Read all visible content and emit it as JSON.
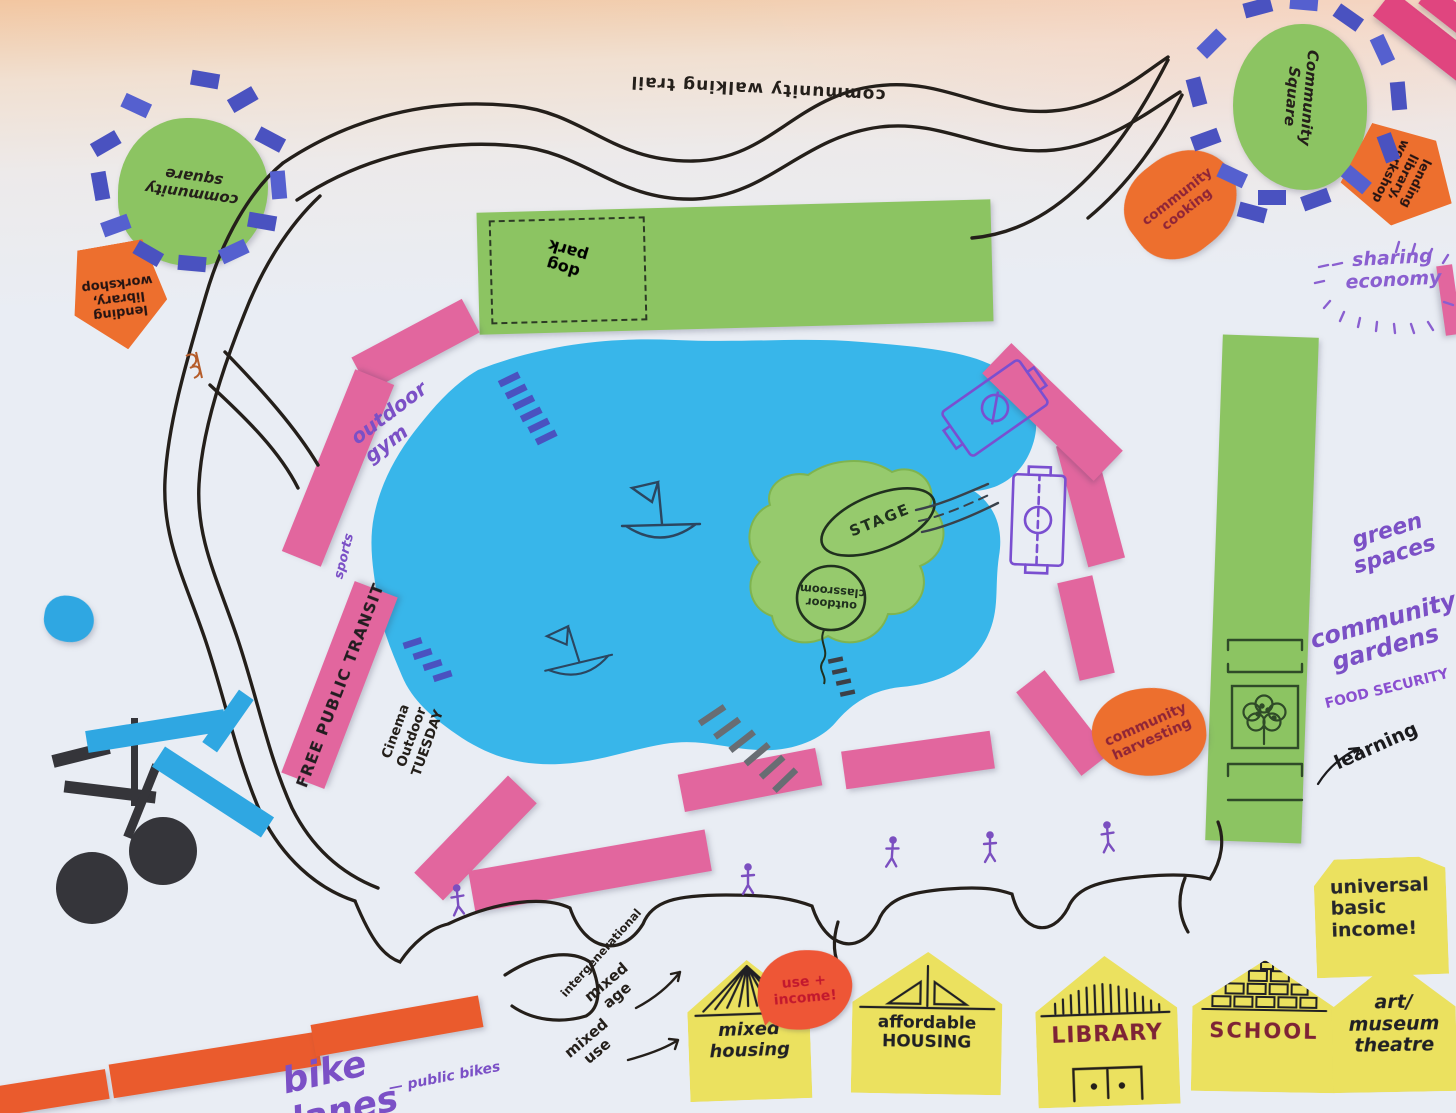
{
  "labels": {
    "walking_trail": "community walking trail",
    "community_square_left": "community\nsquare",
    "community_square_right": "Community\nSquare",
    "lending_library_left": "lending\nlibrary,\nworkshop",
    "lending_library_right": "lending\nlibrary,\nworkshop",
    "community_cooking": "community\ncooking",
    "sharing_economy": "sharing\neconomy",
    "dog_park": "dog\npark",
    "outdoor_gym": "outdoor gym",
    "sports": "sports",
    "free_public_transit": "FREE PUBLIC TRANSIT",
    "outdoor_cinema": "Cinema\nOutdoor\nTUESDAY",
    "stage": "STAGE",
    "outdoor_classroom": "outdoor\nclassroom",
    "community_harvesting": "community\nharvesting",
    "green_spaces": "green\nspaces",
    "community_gardens": "community\ngardens",
    "food_security": "FOOD SECURITY",
    "learning": "learning",
    "universal_basic_income": "universal\nbasic\nincome!",
    "use_income": "use +\nincome!",
    "mixed_housing": "mixed\nhousing",
    "affordable_housing": "affordable\nHOUSING",
    "library": "LIBRARY",
    "school": "SCHOOL",
    "art_museum_theatre": "art/\nmuseum\ntheatre",
    "intergenerational": "intergenerational",
    "mixed_age": "mixed\nage",
    "mixed_use": "mixed\nuse",
    "bike_lanes": "bike lanes",
    "public_bikes": "— public bikes"
  },
  "colors": {
    "paper_green": "#8cc462",
    "island_green": "#96ca6d",
    "lake_blue": "#38b6ea",
    "transit_pink": "#e2669e",
    "corner_pink": "#e0457f",
    "note_orange": "#ed6f2e",
    "bubble_orange": "#ee5636",
    "house_yellow": "#ebe15f",
    "building_blue": "#4a52c0",
    "craft_blue": "#2fa7e2",
    "lane_red": "#ea5b2d",
    "ink_black": "#241f1a",
    "marker_purple": "#7b50c6",
    "dark_red": "#8e2437"
  },
  "icons": {
    "sailboat": "hand-drawn sailboat on lake",
    "bicycle": "paper-craft bicycle",
    "soccer_field": "hand-drawn soccer pitch",
    "tree": "hand-drawn tree in garden plot",
    "pedestrian": "purple stick-figure walker",
    "building": "blue paper building block",
    "ladder": "hand-drawn dock steps",
    "bridge": "hand-drawn bridge to island"
  }
}
